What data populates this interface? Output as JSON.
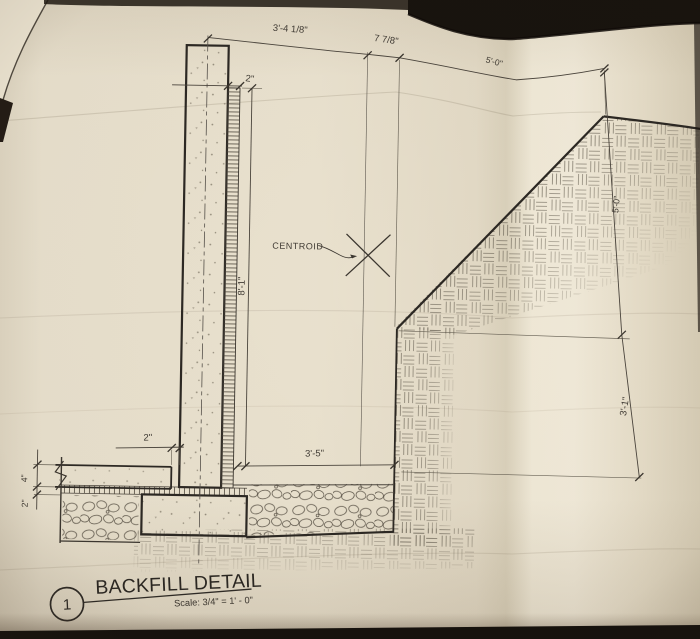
{
  "title_block": {
    "detail_number": "1",
    "title": "BACKFILL DETAIL",
    "scale": "Scale: 3/4\" = 1' - 0\""
  },
  "labels": {
    "centroid": "CENTROID"
  },
  "dims": {
    "wall_cl_to_centroid": "3'-4 1/8\"",
    "centroid_to_backfill": "7 7/8\"",
    "slope_run": "5'-0\"",
    "drain_board_width": "2\"",
    "wall_height": "8'-1\"",
    "backfill_width": "3'-5\"",
    "slope_rise": "5'-0\"",
    "toe_depth": "3'-1\"",
    "slab_gap": "2\"",
    "slab_thickness": "4\"",
    "bedding_thickness": "2\""
  },
  "colors": {
    "paper": "#e8e0cd",
    "ink": "#3b362f",
    "heavy_ink": "#2c2823",
    "table_dark": "#17120d"
  }
}
